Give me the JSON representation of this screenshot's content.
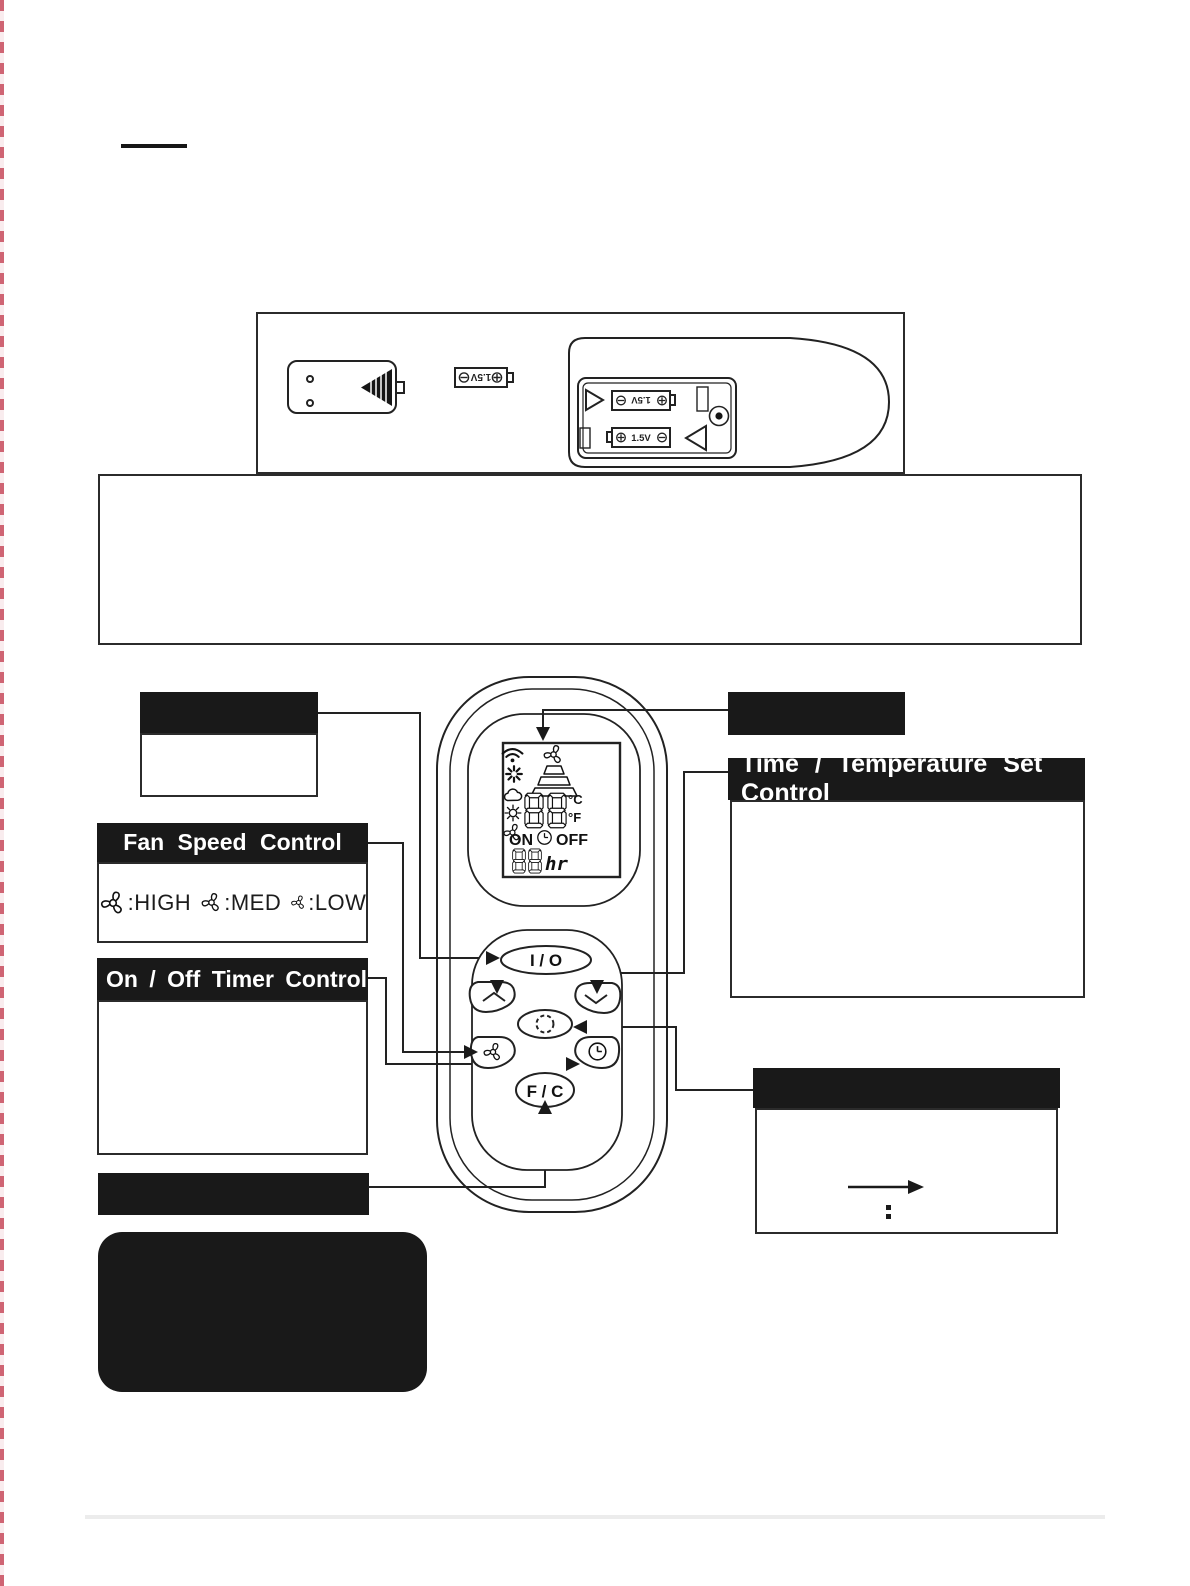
{
  "page": {
    "edge_color": "#cf6473"
  },
  "callouts": {
    "time_temp_title": "Time / Temperature Set Control",
    "fan_speed_title": "Fan Speed Control",
    "fan_levels": [
      {
        "text": ":HIGH"
      },
      {
        "text": ":MED"
      },
      {
        "text": ":LOW"
      }
    ],
    "timer_title": "On / Off Timer Control"
  },
  "remote": {
    "io_button": "I / O",
    "fc_button": "F / C",
    "display": {
      "on": "ON",
      "off": "OFF",
      "deg_c": "°C",
      "deg_f": "°F",
      "timer_unit": "hr"
    }
  },
  "battery": {
    "voltage": "1.5V"
  },
  "icons": {
    "display_left": [
      "wifi-icon",
      "heat-burst-icon",
      "cloud-icon",
      "sun-icon",
      "fan-icon"
    ],
    "display_top": [
      "fan-icon",
      "flame-cone-icon"
    ],
    "buttons": [
      "chevron-up-icon",
      "chevron-down-icon",
      "mode-circle-icon",
      "fan-icon",
      "clock-icon"
    ]
  }
}
